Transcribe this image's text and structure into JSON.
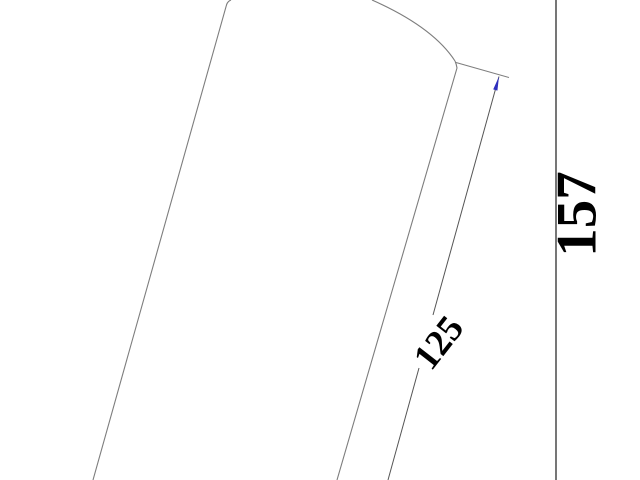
{
  "canvas": {
    "width": 640,
    "height": 480,
    "background": "#ffffff"
  },
  "part": {
    "description": "tilted cylindrical part outline, cropped by viewport",
    "outline_color": "#7d7d7d"
  },
  "dimensions": [
    {
      "value": "125",
      "orientation": "aligned-with-edge",
      "line_color": "#555555",
      "arrow_color": "#2f2fbe",
      "text_color": "#000000"
    },
    {
      "value": "157",
      "orientation": "vertical",
      "line_color": "#3d3d3d",
      "text_color": "#000000"
    }
  ]
}
